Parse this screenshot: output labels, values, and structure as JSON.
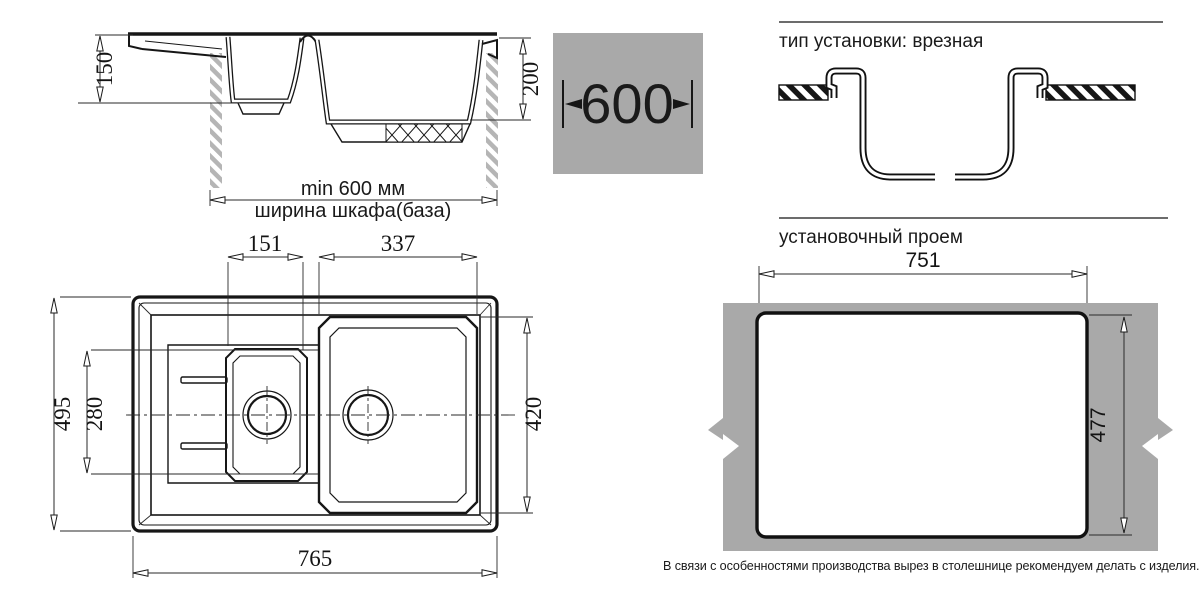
{
  "section_view": {
    "dim_small_bowl_depth": "150",
    "dim_large_bowl_depth": "200",
    "dim_cabinet_min": "min 600 мм",
    "cabinet_label": "ширина шкафа(база)"
  },
  "cabinet_badge": {
    "width": "600"
  },
  "install_type": {
    "title": "тип установки: врезная"
  },
  "cutout_view": {
    "title": "установочный проем",
    "dim_width": "751",
    "dim_height": "477",
    "note": "В связи с особенностями производства вырез в столешнице рекомендуем делать с изделия."
  },
  "top_view": {
    "dim_small_bowl_width": "151",
    "dim_large_bowl_width": "337",
    "dim_overall_depth": "495",
    "dim_bowl_zone_depth": "280",
    "dim_large_bowl_height": "420",
    "dim_overall_width": "765"
  },
  "colors": {
    "panel_gray": "#a9a9a9",
    "hatch_gray": "#b5b5b5",
    "line_black": "#1a1a1a"
  }
}
